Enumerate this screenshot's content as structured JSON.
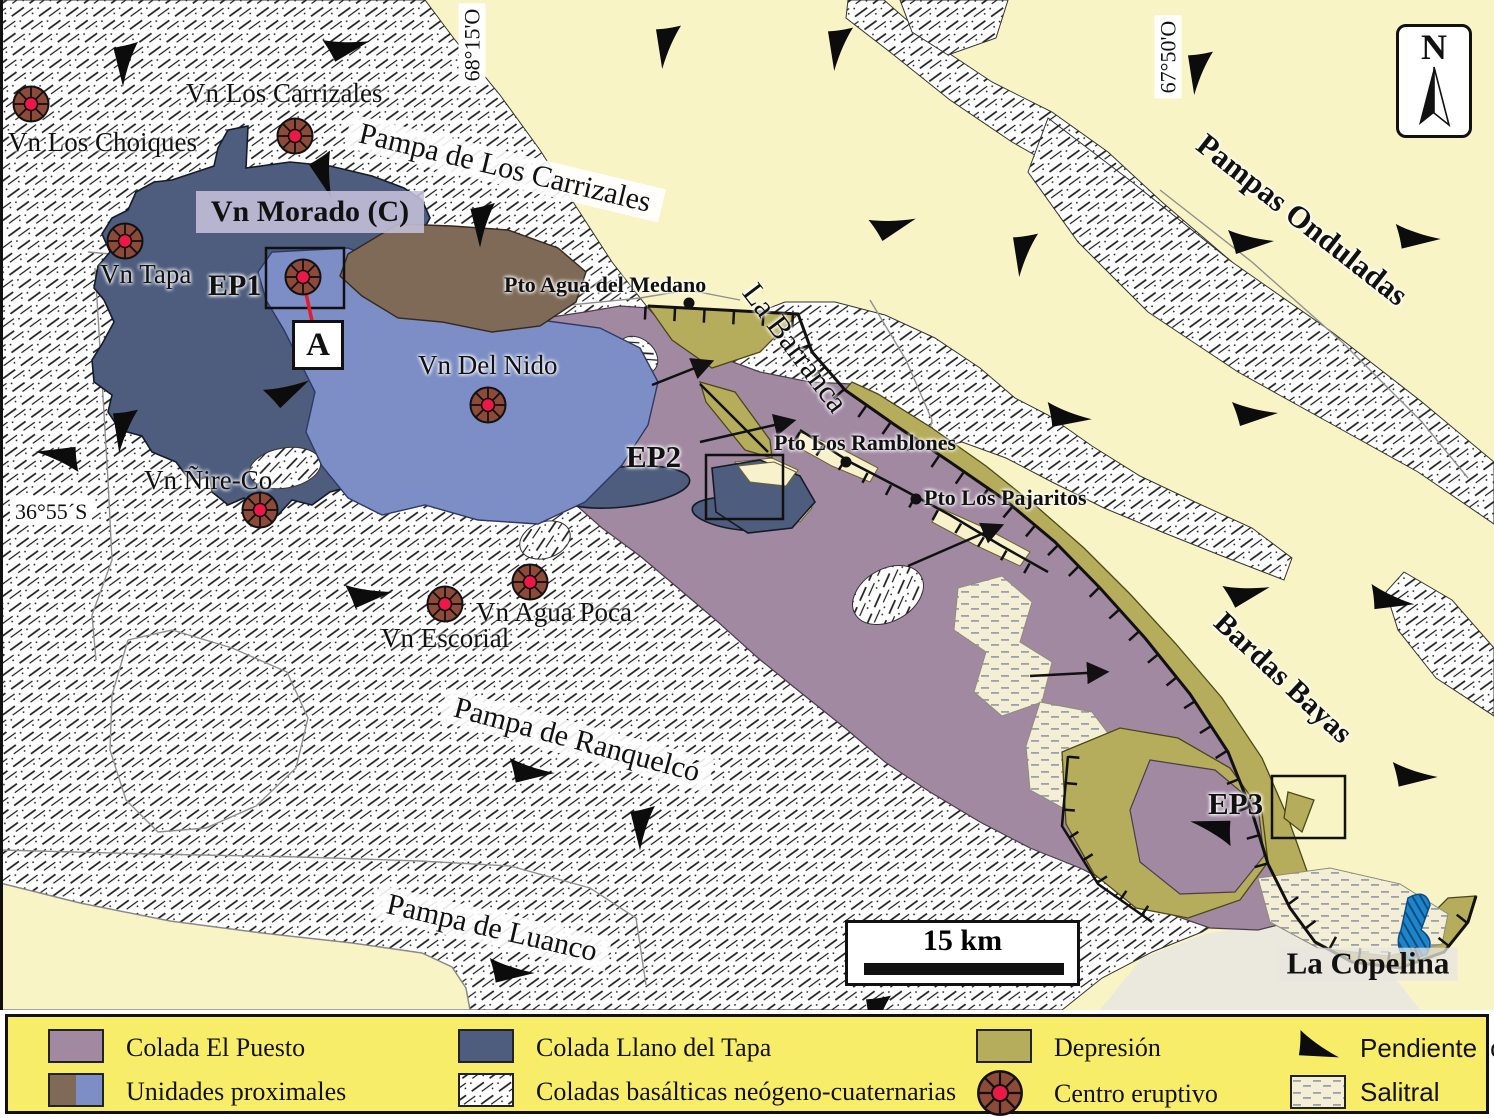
{
  "map": {
    "coordinates": {
      "top_left": "68°15'O",
      "top_right": "67°50'O",
      "left": "36°55´S"
    },
    "north_label": "N",
    "scale_label": "15 km",
    "volcano_labels": {
      "los_choiques": "Vn Los Choiques",
      "los_carrizales": "Vn Los Carrizales",
      "morado": "Vn Morado (C)",
      "tapa": "Vn Tapa",
      "del_nido": "Vn Del Nido",
      "nire_co": "Vn Ñire-Co",
      "escorial": "Vn Escorial",
      "agua_poca": "Vn Agua Poca"
    },
    "site_labels": {
      "ep1": "EP1",
      "ep2": "EP2",
      "ep3": "EP3",
      "a": "A"
    },
    "place_labels": {
      "pto_agua_del_medano": "Pto Agua del Medano",
      "pto_los_ramblones": "Pto Los Ramblones",
      "pto_los_pajaritos": "Pto Los Pajaritos",
      "la_barranca": "La Barranca",
      "pampas_onduladas": "Pampas Onduladas",
      "bardas_bayas": "Bardas Bayas",
      "la_copelina": "La Copelina",
      "pampa_de_los_carrizales": "Pampa de Los Carrizales",
      "pampa_de_ranquelco": "Pampa de Ranquelcó",
      "pampa_de_luanco": "Pampa de Luanco"
    }
  },
  "legend": {
    "items": [
      {
        "id": "colada-el-puesto",
        "label": "Colada El Puesto"
      },
      {
        "id": "unidades-proximales",
        "label": "Unidades proximales"
      },
      {
        "id": "colada-llano-del-tapa",
        "label": "Colada Llano del Tapa"
      },
      {
        "id": "coladas-basalticas",
        "label": "Coladas basálticas neógeno-cuaternarias"
      },
      {
        "id": "depresion",
        "label": "Depresión"
      },
      {
        "id": "centro-eruptivo",
        "label": "Centro eruptivo"
      },
      {
        "id": "pendiente-local",
        "label": "Pendiente local"
      },
      {
        "id": "salitral",
        "label": "Salitral"
      }
    ]
  },
  "colors": {
    "colada_el_puesto": "#a189a2",
    "colada_llano_del_tapa": "#4e5d7e",
    "unidades_proximales_brown": "#7e6a57",
    "unidades_proximales_blue": "#7c8ec5",
    "depresion": "#b6ad5c",
    "pampa_background": "#f9f4c5",
    "legend_background": "#f8ed68",
    "eruptive_center_body": "#8d4a38",
    "eruptive_center_core": "#ee1848",
    "water": "#1e86c8"
  }
}
